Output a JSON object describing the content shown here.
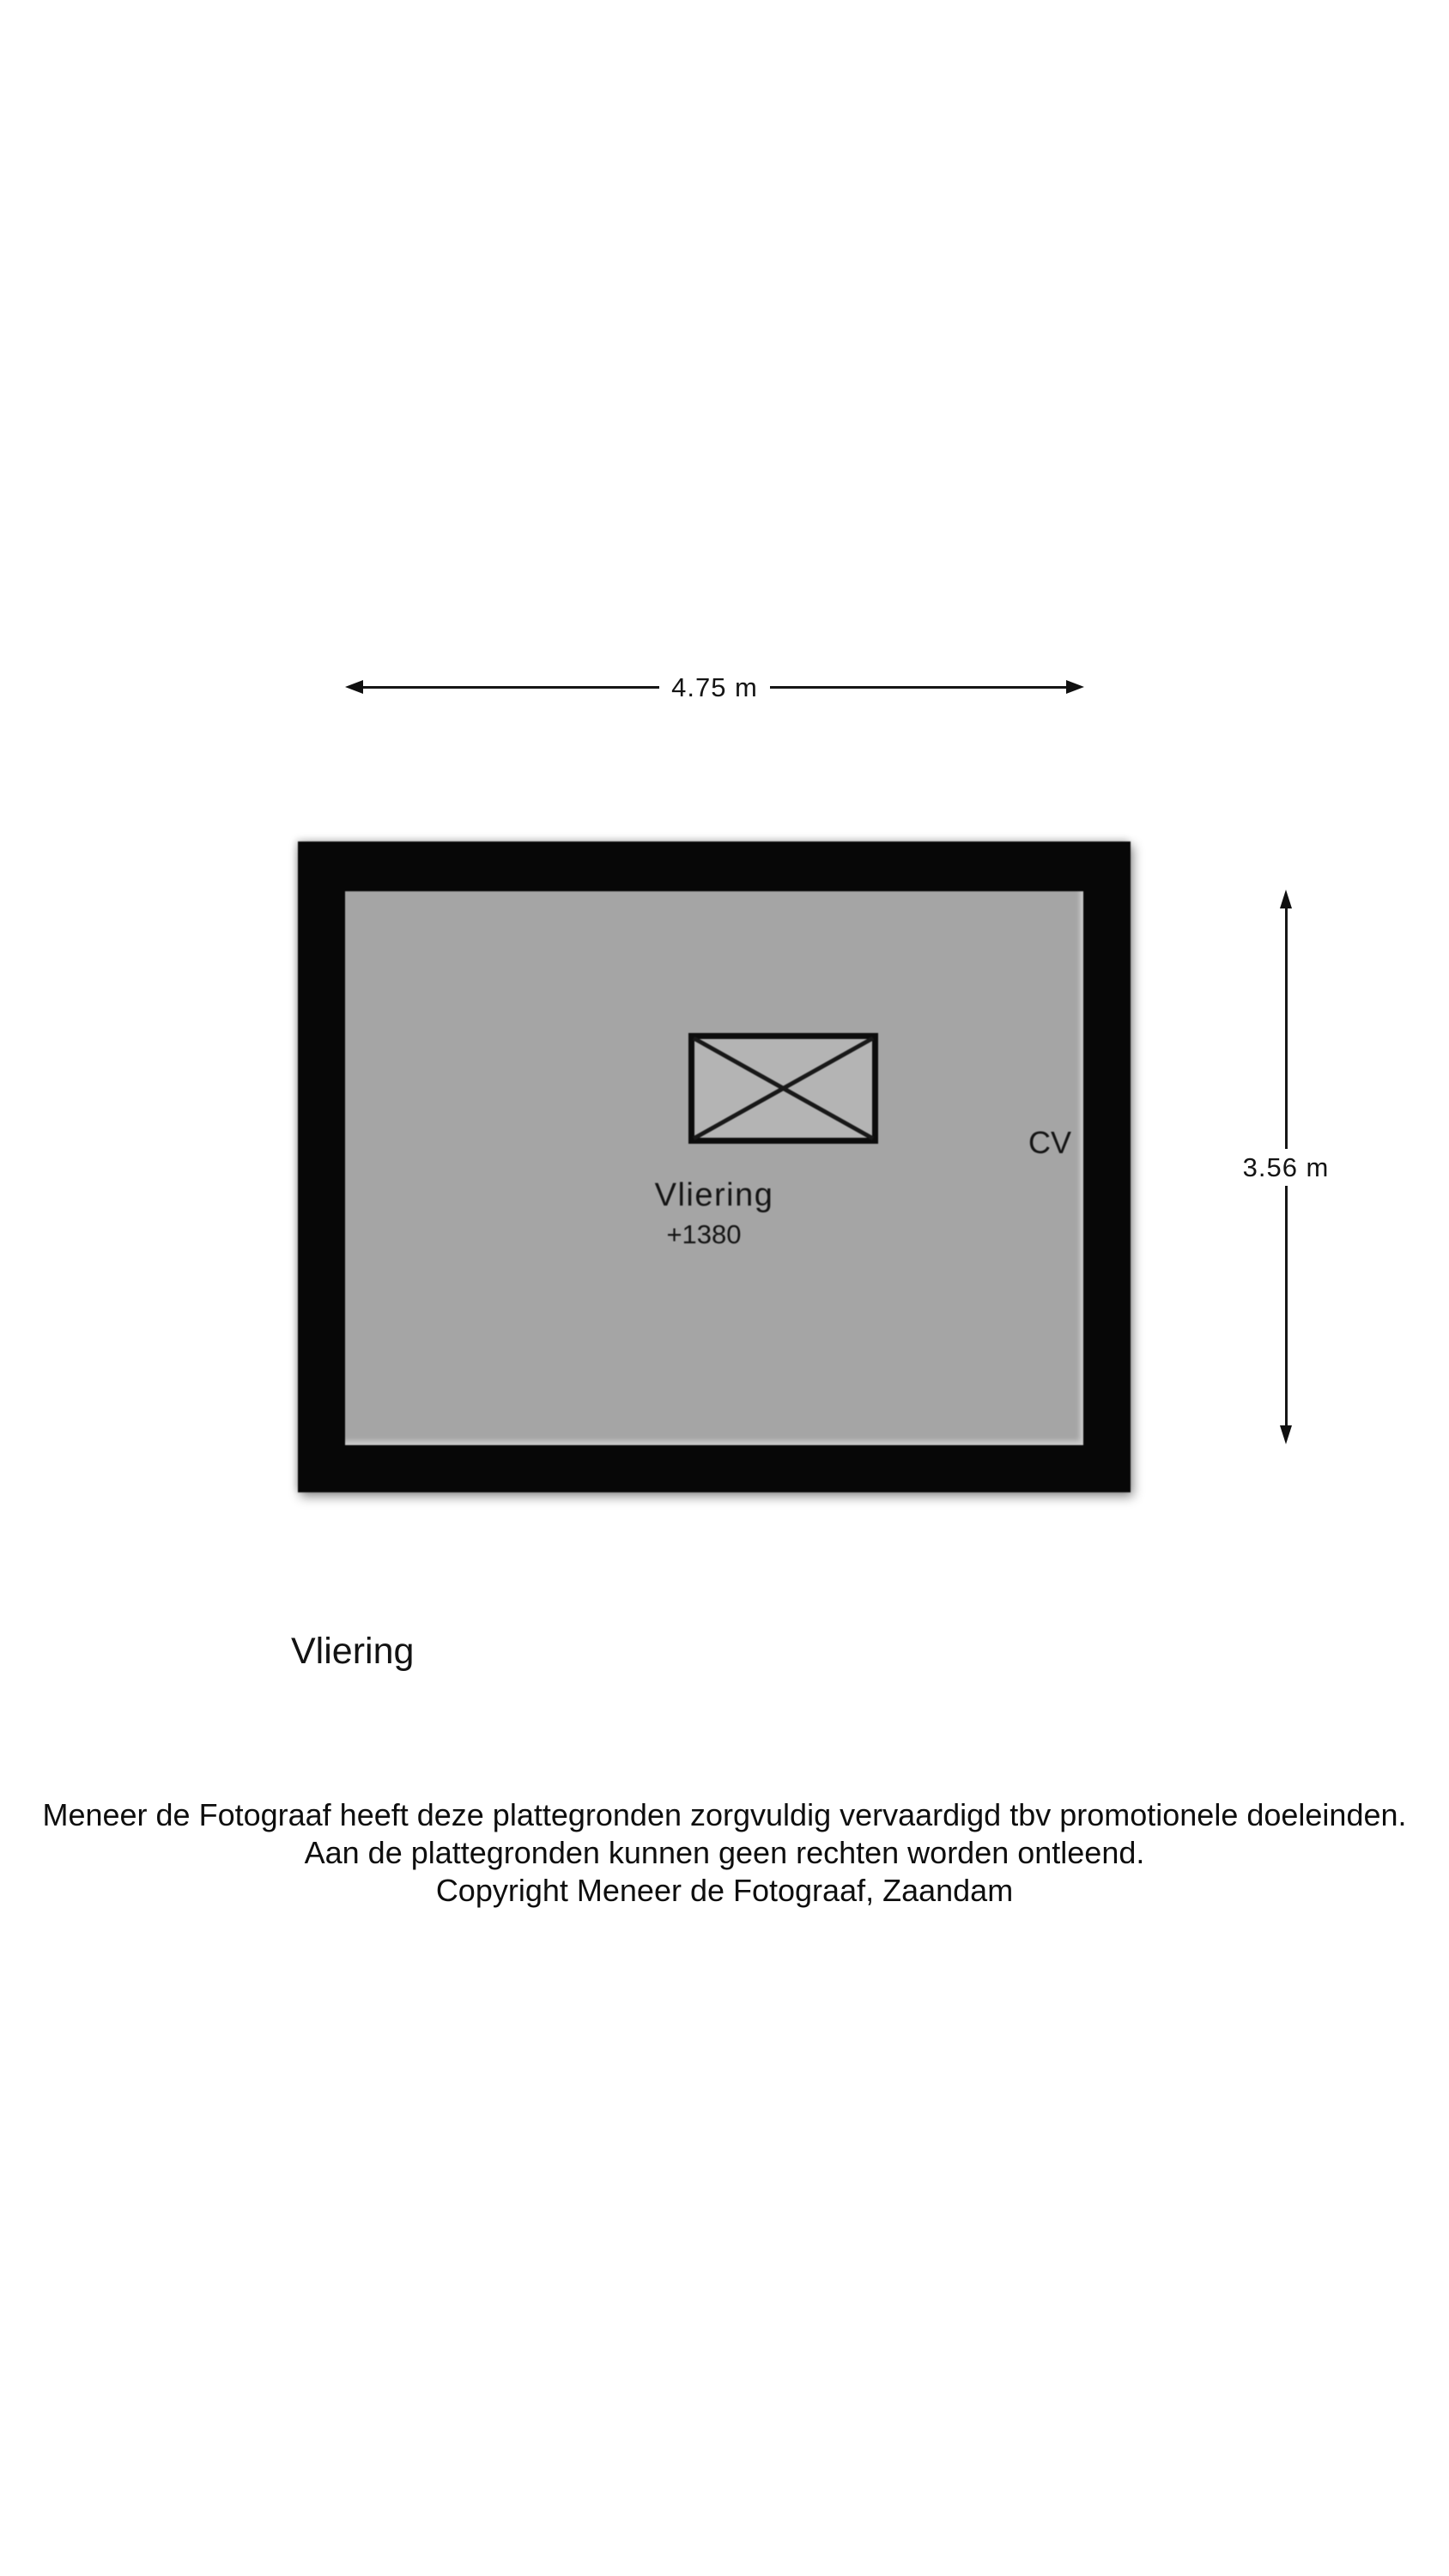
{
  "floorplan": {
    "dimensions": {
      "width_label": "4.75 m",
      "height_label": "3.56 m"
    },
    "room": {
      "name": "Vliering",
      "elevation": "+1380",
      "cv_label": "CV"
    },
    "colors": {
      "wall": "#070707",
      "floor": "#a5a5a5",
      "hatch_fill": "#b4b4b4",
      "line": "#161616",
      "background": "#ffffff"
    }
  },
  "caption": {
    "title": "Vliering"
  },
  "disclaimer": {
    "lines": [
      "Meneer de Fotograaf heeft deze plattegronden zorgvuldig vervaardigd tbv promotionele doeleinden.",
      "Aan de plattegronden kunnen geen rechten worden ontleend.",
      "Copyright Meneer de Fotograaf, Zaandam"
    ]
  }
}
